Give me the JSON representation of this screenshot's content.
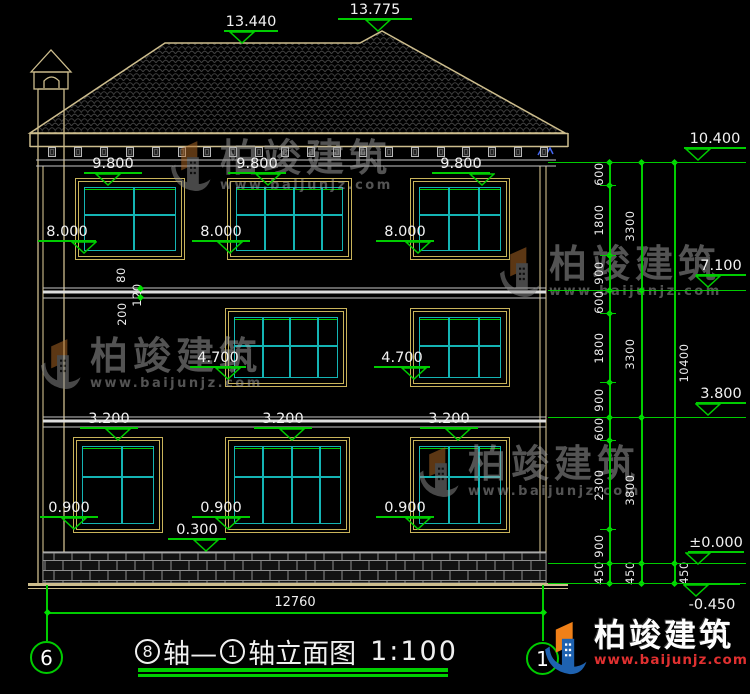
{
  "drawing": {
    "level_markers": [
      "13.440",
      "13.775",
      "9.800",
      "9.800",
      "9.800",
      "8.000",
      "8.000",
      "8.000",
      "4.700",
      "4.700",
      "3.200",
      "3.200",
      "3.200",
      "0.900",
      "0.900",
      "0.900",
      "0.300",
      "10.400",
      "7.100",
      "3.800",
      "±0.000",
      "-0.450"
    ],
    "dim_chains": {
      "col1": [
        "600",
        "1800",
        "900",
        "600",
        "1800",
        "900",
        "600",
        "2300",
        "900",
        "450"
      ],
      "col2": [
        "3300",
        "3300",
        "3800",
        "450"
      ],
      "col3": [
        "10400",
        "450"
      ]
    },
    "band_dims": [
      "80",
      "120",
      "200"
    ],
    "bottom_dim": "12760"
  },
  "title": {
    "axis_a": "8",
    "sep": "轴— ",
    "axis_b": "1",
    "suffix": "轴立面图",
    "scale": "1:100"
  },
  "axis_bubbles": {
    "left": "6",
    "right": "1"
  },
  "watermark": {
    "brand": "柏竣建筑",
    "url": "www.baijunjz.com"
  },
  "logo": {
    "brand": "柏竣建筑",
    "url": "www.baijunjz.com"
  }
}
